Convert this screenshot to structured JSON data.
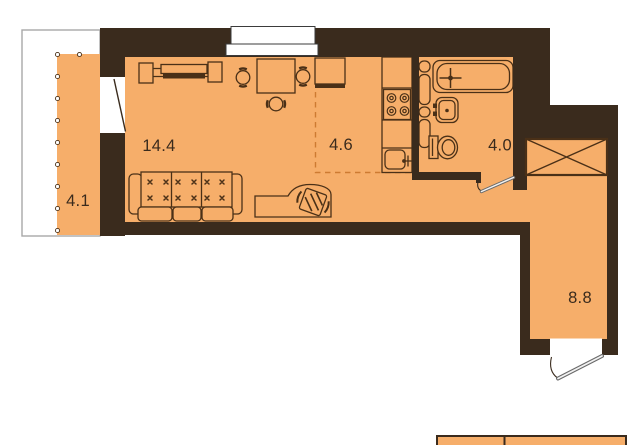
{
  "plan_title": "studio-apartment-floor-plan",
  "rooms": {
    "living": {
      "area": "14.4"
    },
    "kitchen": {
      "area": "4.6"
    },
    "bathroom": {
      "area": "4.0"
    },
    "balcony": {
      "area": "4.1"
    },
    "hallway": {
      "area": "8.8"
    }
  },
  "fixtures": [
    "bench",
    "dining-table",
    "chair",
    "sofa",
    "desk",
    "office-chair",
    "kitchen-cabinet",
    "stove",
    "kitchen-sink",
    "bathtub",
    "towel-rail-column",
    "bathroom-sink",
    "toilet",
    "wardrobe",
    "window",
    "balcony-door",
    "bathroom-door",
    "entrance-door"
  ],
  "colors": {
    "floor": "#F6AE6A",
    "wall": "#3A2B1D",
    "line": "#4A3017",
    "dash": "#CD7B32",
    "door_leaf": "#6A6A6A",
    "balcony_border": "#A8A8A8",
    "text": "#3A2B1D"
  }
}
